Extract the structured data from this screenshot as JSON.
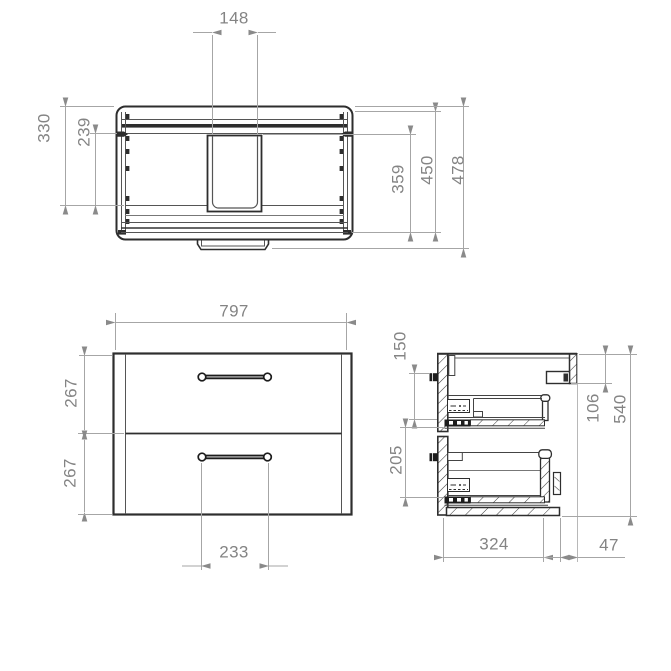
{
  "colors": {
    "background": "#ffffff",
    "linework": "#2e2e2e",
    "hatch": "#3c3c3c",
    "dimension_line": "#a6a6a6",
    "dimension_arrow": "#8a8a8a",
    "dimension_text": "#848484"
  },
  "views": {
    "plan": {
      "dims": {
        "d148": "148",
        "d330": "330",
        "d239": "239",
        "d359": "359",
        "d450": "450",
        "d478": "478"
      }
    },
    "front": {
      "dims": {
        "d797": "797",
        "d267a": "267",
        "d267b": "267",
        "d233": "233"
      }
    },
    "side": {
      "dims": {
        "d150": "150",
        "d205": "205",
        "d106": "106",
        "d540": "540",
        "d324": "324",
        "d47": "47"
      }
    }
  }
}
